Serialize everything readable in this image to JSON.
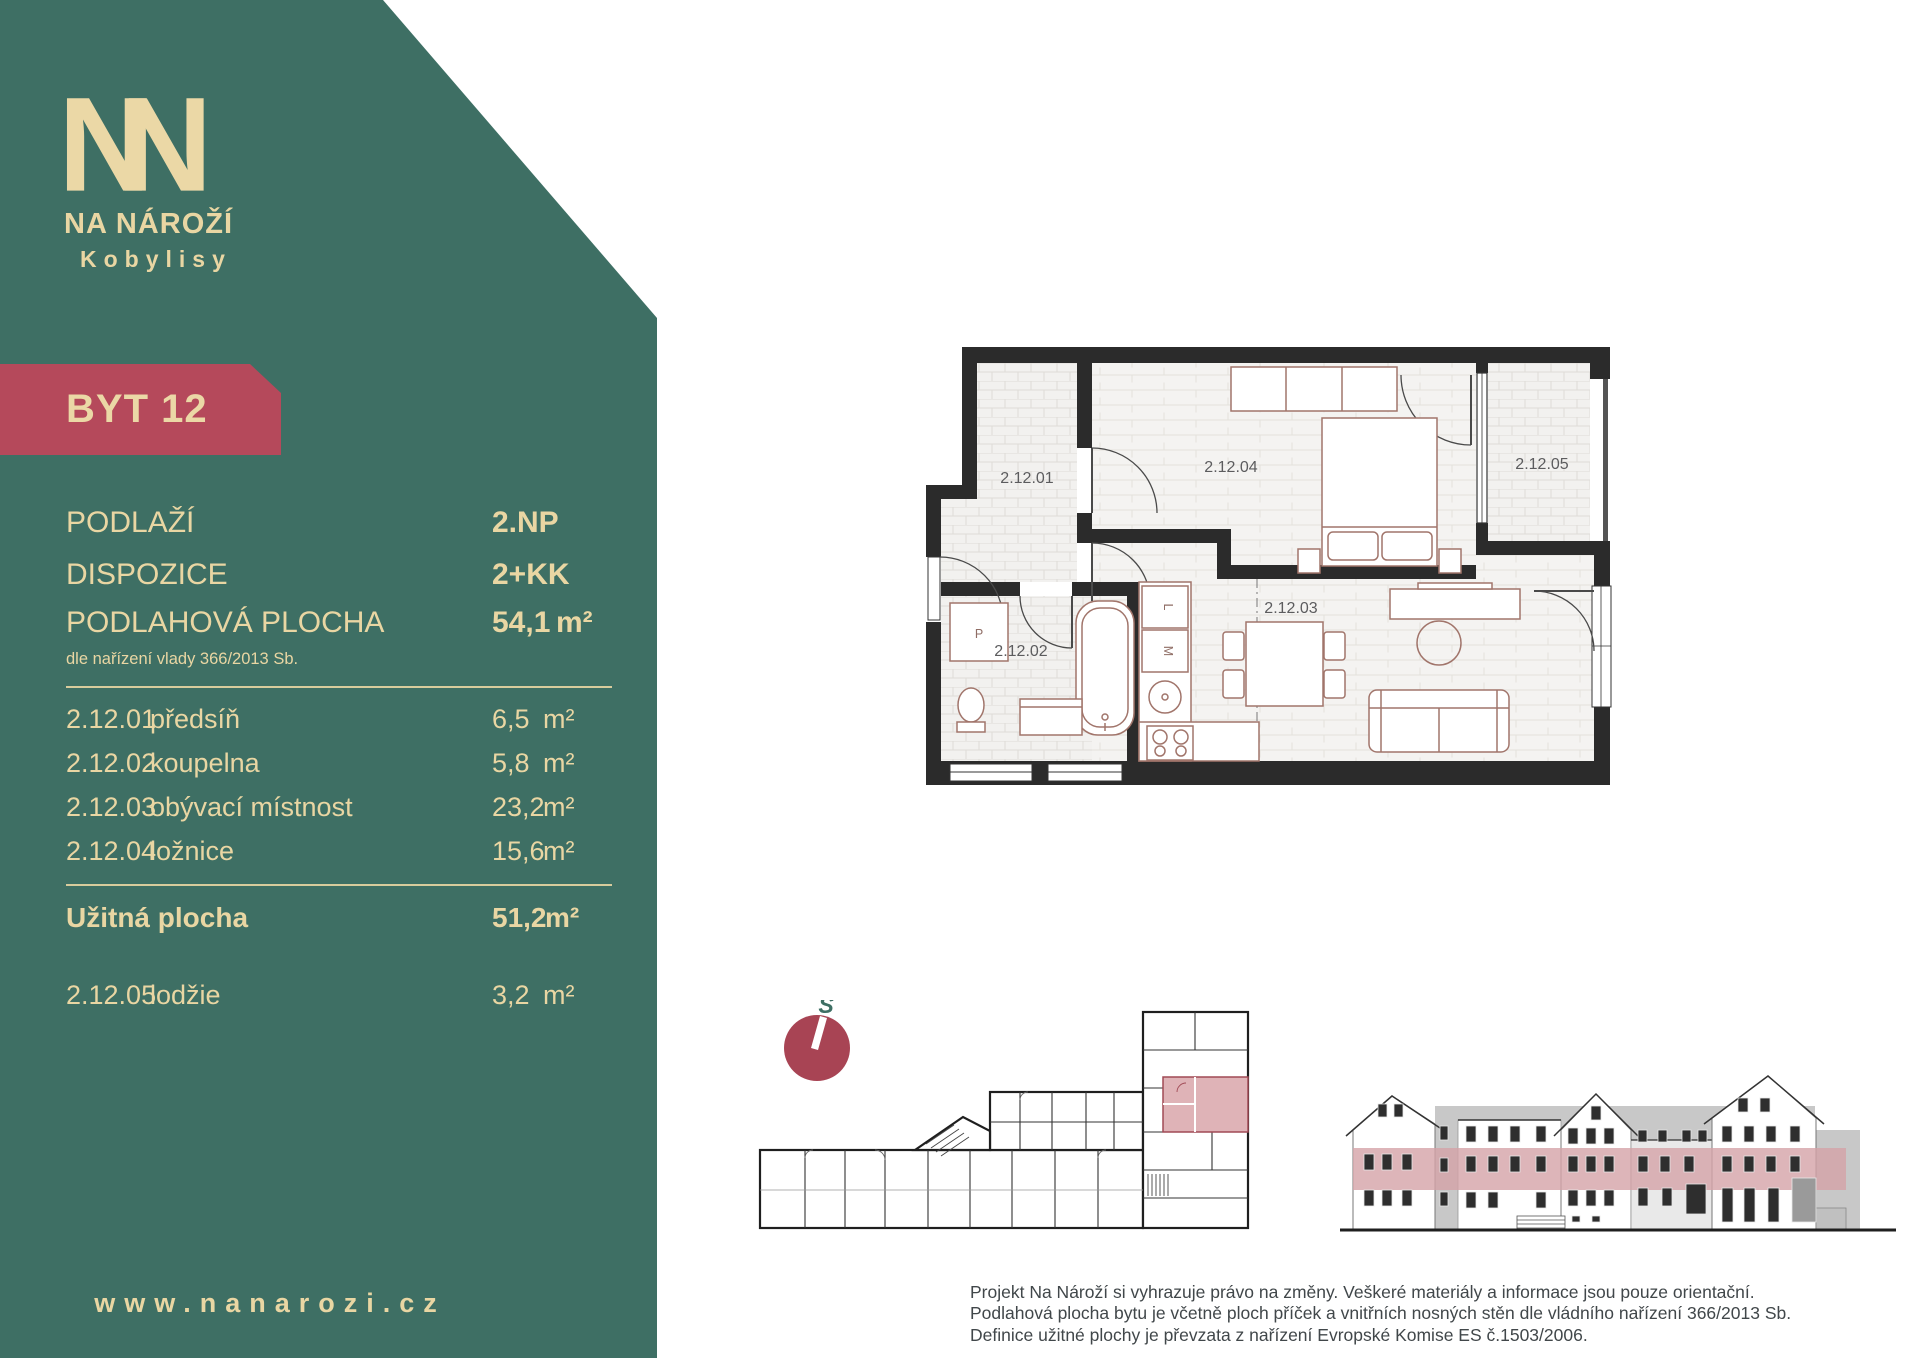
{
  "colors": {
    "teal": "#3E6F64",
    "cream": "#E9D6A3",
    "badge_red": "#B5495B",
    "compass_red": "#A84454",
    "highlight_pink": "#DFB3B7",
    "elevation_band_pink": "#D5A3A8"
  },
  "brand": {
    "monogram_n": "N",
    "line1": "NA NÁROŽÍ",
    "line2": "Kobylisy"
  },
  "badge": {
    "label": "BYT 12"
  },
  "summary": {
    "rows": [
      {
        "label": "PODLAŽÍ",
        "value": "2.NP"
      },
      {
        "label": "DISPOZICE",
        "value": "2+KK"
      },
      {
        "label": "PODLAHOVÁ PLOCHA",
        "value": "54,1",
        "unit": "m²"
      }
    ],
    "note": "dle nařízení vlady 366/2013 Sb."
  },
  "room_table": {
    "rows": [
      {
        "code": "2.12.01",
        "name": "předsíň",
        "area": "6,5",
        "unit": "m²"
      },
      {
        "code": "2.12.02",
        "name": "koupelna",
        "area": "5,8",
        "unit": "m²"
      },
      {
        "code": "2.12.03",
        "name": "obývací místnost",
        "area": "23,2",
        "unit": "m²"
      },
      {
        "code": "2.12.04",
        "name": "ložnice",
        "area": "15,6",
        "unit": "m²"
      }
    ],
    "total": {
      "label": "Užitná plocha",
      "area": "51,2",
      "unit": "m²"
    },
    "extra": {
      "code": "2.12.05",
      "name": "lodžie",
      "area": "3,2",
      "unit": "m²"
    }
  },
  "website": "www.nanarozi.cz",
  "floorplan": {
    "labels": {
      "hall": "2.12.01",
      "bath": "2.12.02",
      "living": "2.12.03",
      "bedroom": "2.12.04",
      "loggia": "2.12.05"
    },
    "appliances": {
      "washer": "P",
      "fridge": "L",
      "dishwasher": "M"
    }
  },
  "compass": {
    "north_letter": "S"
  },
  "disclaimer": {
    "line1": "Projekt Na Nároží si vyhrazuje právo na změny. Veškeré materiály a informace jsou pouze orientační.",
    "line2": "Podlahová plocha bytu je včetně ploch příček a vnitřních nosných stěn dle vládního nařízení 366/2013 Sb.",
    "line3": "Definice užitné plochy je převzata z nařízení Evropské Komise ES č.1503/2006."
  }
}
